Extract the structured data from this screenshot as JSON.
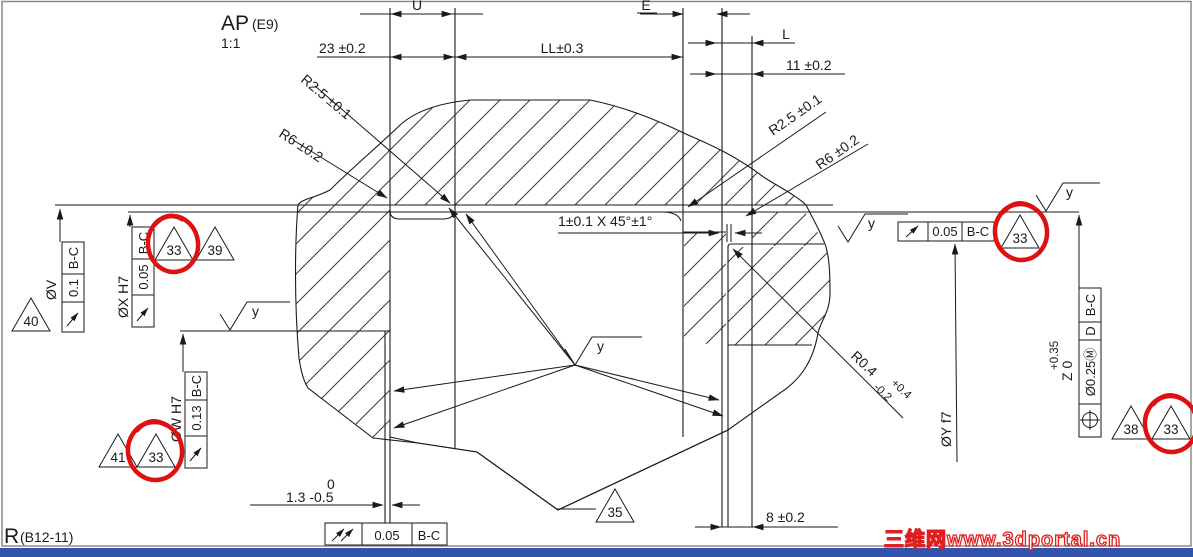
{
  "title": {
    "name": "AP",
    "variant": "(E9)",
    "scale": "1:1"
  },
  "ref": {
    "name": "R",
    "code": "(B12-11)"
  },
  "watermark": "三维网www.3dportal.cn",
  "dims": {
    "u": "U",
    "d23": "23 ±0.2",
    "ll": "LL±0.3",
    "e": "E",
    "l": "L",
    "d11": "11 ±0.2",
    "d8": "8 ±0.2",
    "d13": "1.3 -0.5",
    "d13_sup": "0",
    "chamfer": "1±0.1 X 45°±1°"
  },
  "radii": {
    "r25_left": "R2.5 ±0.1",
    "r6_left": "R6 ±0.2",
    "r25_right": "R2.5 ±0.1",
    "r6_right": "R6 ±0.2",
    "r04": "R0.4",
    "r04_plus": "+0.4",
    "r04_minus": "-0.2"
  },
  "labels": {
    "dv": "ØV",
    "dx": "ØX H7",
    "dw": "ØW H7",
    "dy": "ØY f7",
    "z": "Z 0",
    "z_plus": "+0.35",
    "surface_finish": "y"
  },
  "fcf": {
    "v_val": "0.1",
    "v_dat": "B-C",
    "x_val": "0.05",
    "x_dat": "B-C",
    "w_val": "0.13",
    "w_dat": "B-C",
    "bot_val": "0.05",
    "bot_dat": "B-C",
    "right_val": "0.05",
    "right_dat": "B-C",
    "pos_tol": "Ø0.25Ⓜ",
    "pos_dat1": "D",
    "pos_dat2": "B-C"
  },
  "flags": {
    "f40": "40",
    "f39": "39",
    "f41": "41",
    "f35": "35",
    "f38": "38",
    "f33": "33"
  },
  "colors": {
    "line": "#1a1a1a",
    "annotation_red": "#dd1111",
    "watermark_red": "#e02020",
    "footer_bar_blue": "#3153ac"
  }
}
